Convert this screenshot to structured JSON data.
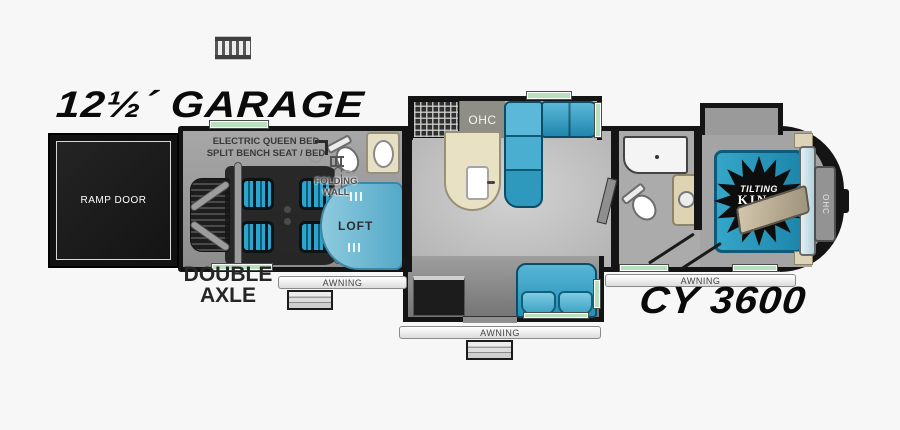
{
  "titles": {
    "garage": "12½´ GARAGE",
    "model": "CY 3600"
  },
  "labels": {
    "ramp_door": "RAMP DOOR",
    "garage_note_1": "ELECTRIC QUEEN BED",
    "garage_note_2": "SPLIT BENCH SEAT / BED",
    "folding_wall_1": "FOLDING",
    "folding_wall_2": "WALL",
    "loft": "LOFT",
    "kitchen_ohc": "OHC",
    "bedroom_ohc": "OHC",
    "double_axle_1": "DOUBLE",
    "double_axle_2": "AXLE"
  },
  "awnings": {
    "garage": "AWNING",
    "main": "AWNING",
    "bedroom": "AWNING"
  },
  "bed_badge": {
    "line1": "TILTING",
    "line2": "KING",
    "line3": "BED"
  },
  "icons": {
    "roof_ladder": "roof-ladder",
    "window_strip": "window",
    "door_swing": "door-swing"
  },
  "colors": {
    "background": "#f7f7f7",
    "wall": "#141414",
    "furniture_teal": "#2e9ec6",
    "loft_blue": "#6fbcd8",
    "window_green": "#b7e0bc",
    "counter_cream": "#e9e1c4",
    "mattress_tan": "#c2b699"
  }
}
